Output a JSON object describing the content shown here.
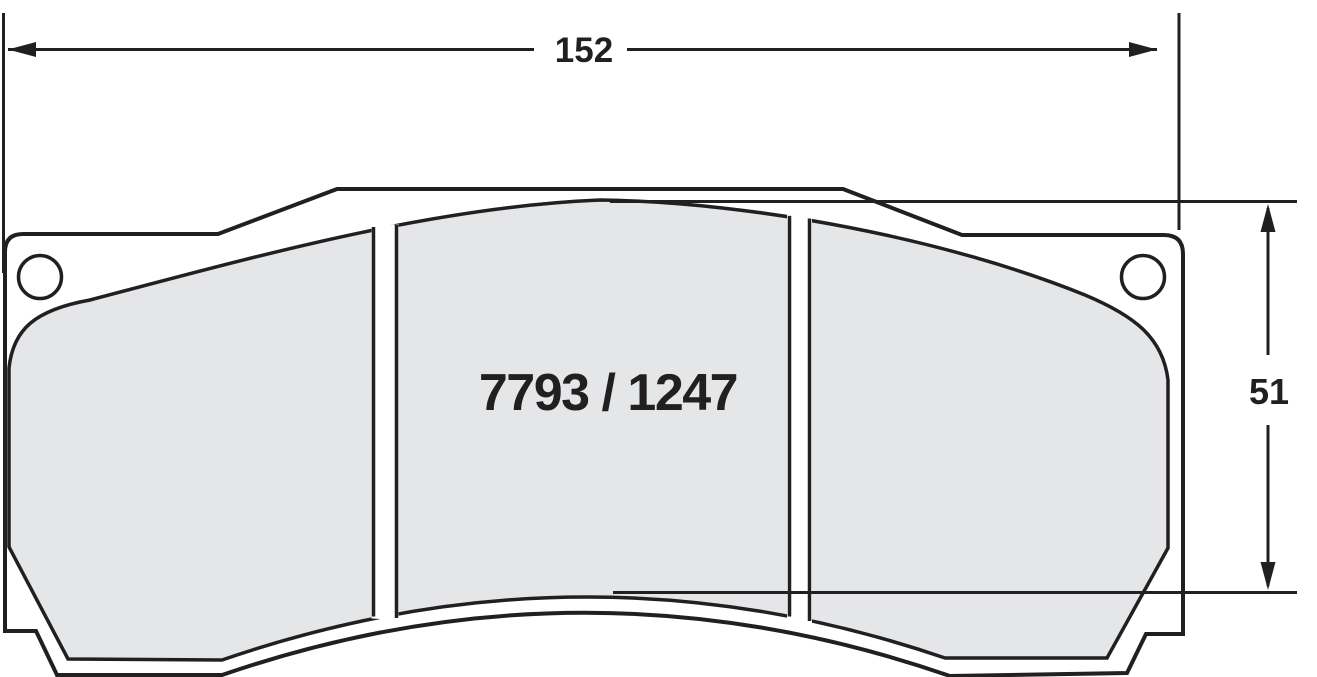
{
  "drawing": {
    "title": "brake pad technical drawing",
    "part_number": "7793 / 1247",
    "width_dimension": "152",
    "height_dimension": "51"
  },
  "colors": {
    "line": "#221f20",
    "friction_fill": "#e5e6e7",
    "plate_fill": "#ffffff",
    "background": "#ffffff"
  }
}
